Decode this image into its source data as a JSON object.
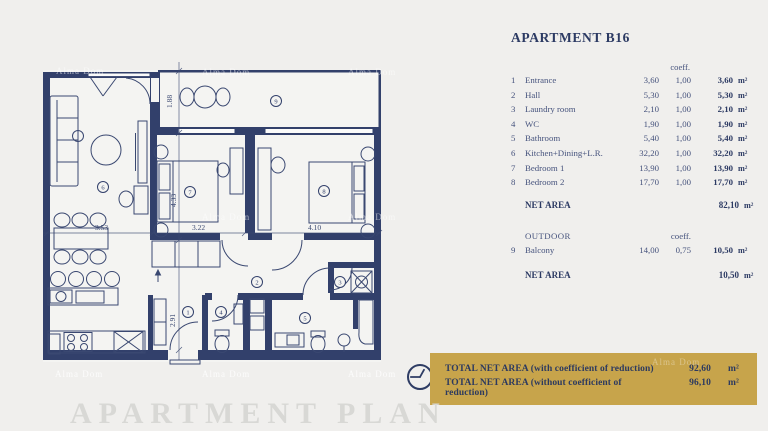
{
  "watermark": {
    "text": "Alma Dom"
  },
  "plan": {
    "dimensions": {
      "d188": "1.88",
      "d433": "4.33",
      "d322": "3.22",
      "d410": "4.10",
      "d353": "3.53",
      "d291": "2.91"
    },
    "rooms": {
      "r1": "1",
      "r2": "2",
      "r3": "3",
      "r4": "4",
      "r5": "5",
      "r6": "6",
      "r7": "7",
      "r8": "8",
      "r9": "9"
    }
  },
  "panel": {
    "title": "APARTMENT B16",
    "coeff_header": "coeff.",
    "unit": "m²",
    "rows": [
      {
        "num": "1",
        "label": "Entrance",
        "area": "3,60",
        "coeff": "1,00",
        "net": "3,60"
      },
      {
        "num": "2",
        "label": "Hall",
        "area": "5,30",
        "coeff": "1,00",
        "net": "5,30"
      },
      {
        "num": "3",
        "label": "Laundry room",
        "area": "2,10",
        "coeff": "1,00",
        "net": "2,10"
      },
      {
        "num": "4",
        "label": "WC",
        "area": "1,90",
        "coeff": "1,00",
        "net": "1,90"
      },
      {
        "num": "5",
        "label": "Bathroom",
        "area": "5,40",
        "coeff": "1,00",
        "net": "5,40"
      },
      {
        "num": "6",
        "label": "Kitchen+Dining+L.R.",
        "area": "32,20",
        "coeff": "1,00",
        "net": "32,20"
      },
      {
        "num": "7",
        "label": "Bedroom 1",
        "area": "13,90",
        "coeff": "1,00",
        "net": "13,90"
      },
      {
        "num": "8",
        "label": "Bedroom 2",
        "area": "17,70",
        "coeff": "1,00",
        "net": "17,70"
      }
    ],
    "net_area_label": "NET AREA",
    "net_area_value": "82,10",
    "outdoor": {
      "section_label": "OUTDOOR",
      "coeff_header": "coeff.",
      "row": {
        "num": "9",
        "label": "Balcony",
        "area": "14,00",
        "coeff": "0,75",
        "net": "10,50"
      },
      "net_area_label": "NET AREA",
      "net_area_value": "10,50"
    }
  },
  "banner": {
    "rows": [
      {
        "label": "TOTAL NET AREA (with coefficient of reduction)",
        "value": "92,60",
        "unit": "m²"
      },
      {
        "label": "TOTAL NET AREA (without coefficient of reduction)",
        "value": "96,10",
        "unit": "m²"
      }
    ]
  },
  "footer": {
    "title": "APARTMENT PLAN"
  }
}
